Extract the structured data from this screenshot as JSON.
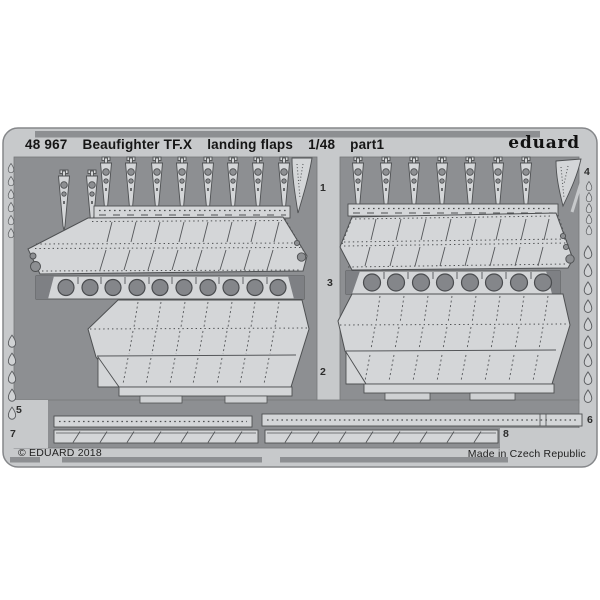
{
  "header": {
    "code": "48 967",
    "name": "Beaufighter TF.X",
    "subject": "landing flaps",
    "scale": "1/48",
    "part": "part1",
    "brand": "eduard"
  },
  "footer": {
    "copyright": "© EDUARD 2018",
    "made_in": "Made in Czech Republic"
  },
  "part_labels": {
    "p1": "1",
    "p2": "2",
    "p3": "3",
    "p4": "4",
    "p5": "5",
    "p6": "6",
    "p7": "7",
    "p8": "8"
  },
  "colors": {
    "background": "#ffffff",
    "fret_frame": "#c7c9cb",
    "etched_field": "#8d8f92",
    "part_metal": "#d4d6d8",
    "part_outline": "#4e5052",
    "hole_fill": "#84868a",
    "text": "#151515"
  }
}
